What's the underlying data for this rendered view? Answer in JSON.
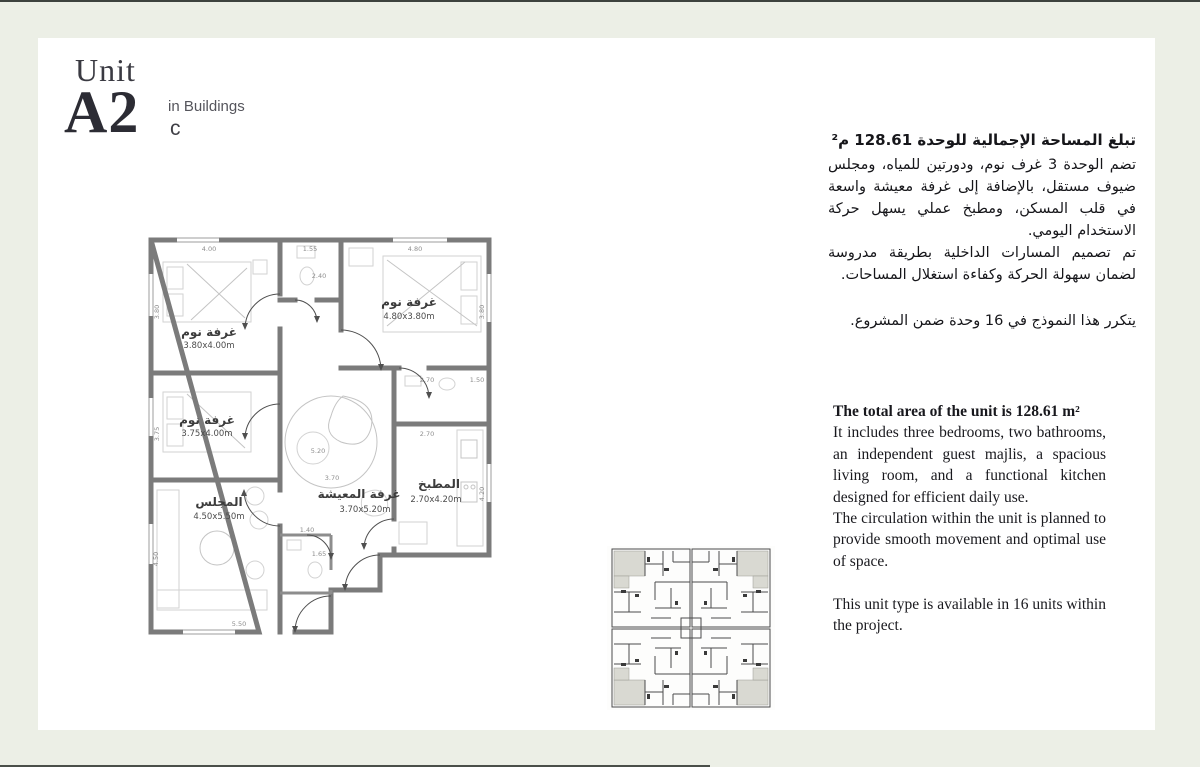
{
  "page": {
    "background": "#ecefe6",
    "panel_background": "#ffffff",
    "rule_color": "#3d423e",
    "wall_color": "#7b7b7b"
  },
  "header": {
    "unit_label": "Unit",
    "unit_code": "A2",
    "in_buildings_label": "in Buildings",
    "building_letter": "c"
  },
  "arabic": {
    "heading": "تبلغ المساحة الإجمالية للوحدة 128.61 م²",
    "para1": "تضم الوحدة 3 غرف نوم، ودورتين للمياه، ومجلس ضيوف مستقل، بالإضافة إلى غرفة معيشة واسعة في قلب المسكن، ومطبخ عملي يسهل حركة الاستخدام اليومي.",
    "para2": "تم تصميم المسارات الداخلية بطريقة مدروسة لضمان سهولة الحركة وكفاءة استغلال المساحات.",
    "para3": "يتكرر هذا النموذج في 16 وحدة ضمن المشروع."
  },
  "english": {
    "heading": "The total area of the unit is 128.61 m²",
    "para1": "It includes three bedrooms, two bathrooms, an independent guest majlis, a spacious living room, and a functional kitchen designed for efficient daily use.",
    "para2": "The circulation within the unit is planned to provide smooth movement and optimal use of space.",
    "para3": "This unit type is available in 16 units within the project."
  },
  "floorplan": {
    "rooms": [
      {
        "name": "غرفة نوم",
        "size": "3.80x4.00m"
      },
      {
        "name": "غرفة نوم",
        "size": "4.80x3.80m"
      },
      {
        "name": "غرفة نوم",
        "size": "3.75x4.00m"
      },
      {
        "name": "المجلس",
        "size": "4.50x5.50m"
      },
      {
        "name": "غرفة المعيشة",
        "size": "3.70x5.20m"
      },
      {
        "name": "المطبخ",
        "size": "2.70x4.20m"
      }
    ],
    "dims": {
      "bed1_top": "4.00",
      "bath1_top": "1.55",
      "bed2_top": "4.80",
      "bed1_left": "3.80",
      "bath1_h": "2.40",
      "bed2_right": "3.80",
      "bed3_left": "3.75",
      "bath2_w": "2.70",
      "bath2_h": "1.50",
      "kitchen_top": "2.70",
      "kitchen_right": "4.20",
      "living_w": "5.20",
      "living_h": "3.70",
      "bath3_w": "1.40",
      "bath3_h": "1.65",
      "majlis_left": "4.50",
      "majlis_bottom": "5.50"
    }
  }
}
